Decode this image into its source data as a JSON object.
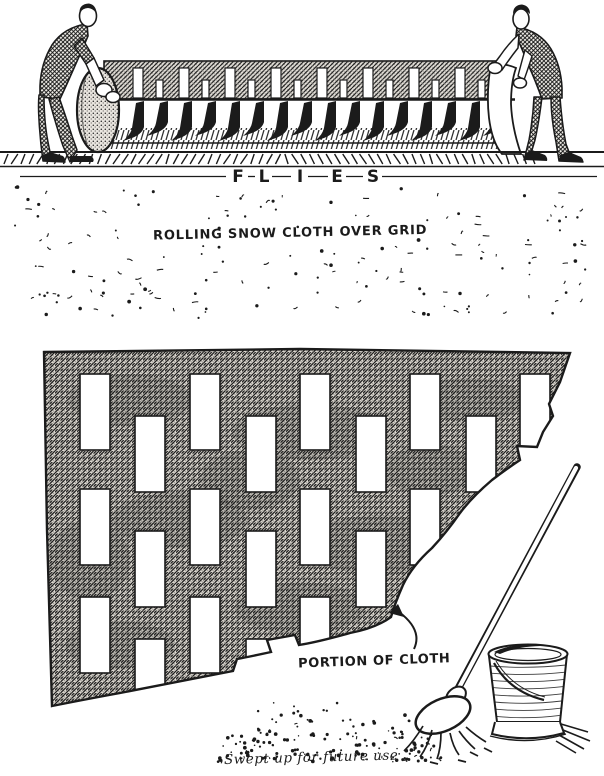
{
  "page": {
    "background": "#ffffff",
    "ink_color": "#1b1b1b",
    "description": "Vintage stagecraft illustration: rolling a perforated snow cloth over the grid"
  },
  "top_scene": {
    "name": "rolling-snow-cloth-over-grid",
    "flies_label": "FLIES",
    "caption": "ROLLING SNOW CLOTH OVER GRID",
    "elements": [
      "stagehand-left",
      "stagehand-right",
      "snow-cloth-roll",
      "grid-floor",
      "falling-snow-speckles"
    ]
  },
  "bottom_scene": {
    "name": "portion-of-cloth-detail",
    "cloth_label": "PORTION OF CLOTH",
    "pile_caption": "Swept up for future use",
    "elements": [
      "perforated-cloth",
      "pointer-arrow",
      "mop",
      "bucket",
      "snow-pile"
    ]
  }
}
